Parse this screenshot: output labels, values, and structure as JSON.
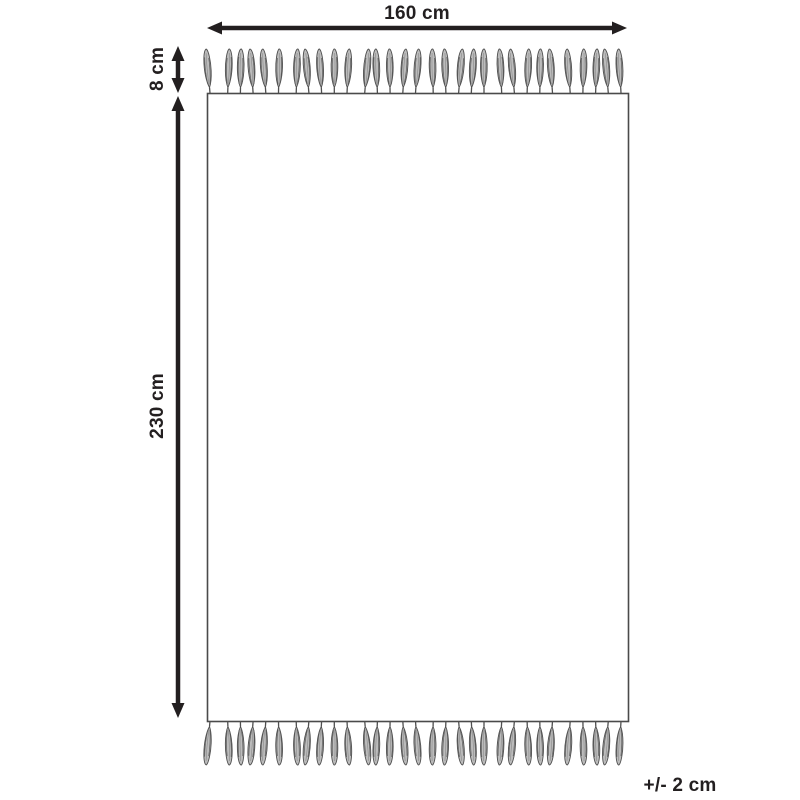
{
  "diagram": {
    "type": "rug-dimension-diagram",
    "labels": {
      "width": "160 cm",
      "fringe": "8 cm",
      "height": "230 cm",
      "tolerance": "+/- 2 cm"
    },
    "tassels": {
      "top_count": 31,
      "bottom_count": 31
    },
    "colors": {
      "background": "#ffffff",
      "dimension_lines": "#231f20",
      "text": "#231f20",
      "rug_outline": "#4a4a4a",
      "rug_fill": "#ffffff",
      "tassel_fill": "#bcbcbc",
      "tassel_stroke": "#4f4f4f",
      "tassel_streak_dark": "#5a5a5a",
      "tassel_streak_light": "#8a8a8a"
    }
  }
}
